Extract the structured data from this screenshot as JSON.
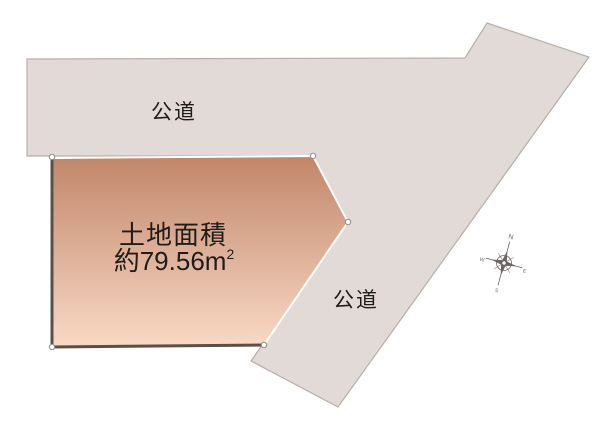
{
  "diagram": {
    "road_label_top": "公道",
    "road_label_right": "公道",
    "plot": {
      "title": "土地面積",
      "area_value": "約79.56",
      "area_unit": "m",
      "area_exponent": "2"
    },
    "compass": {
      "north": "N",
      "east": "E",
      "south": "S",
      "west": "W"
    }
  },
  "colors": {
    "background": "#ffffff",
    "road_fill": "#e1dad6",
    "road_outline": "#b9aea8",
    "plot_gradient_top": "#c1866a",
    "plot_gradient_bottom": "#f9d9c5",
    "plot_dark_border": "#57504b",
    "plot_light_outline": "#ffffff",
    "handle_fill": "#ffffff",
    "handle_outline": "#8f8a86",
    "text": "#1f1d1b",
    "compass": "#6b6560"
  }
}
